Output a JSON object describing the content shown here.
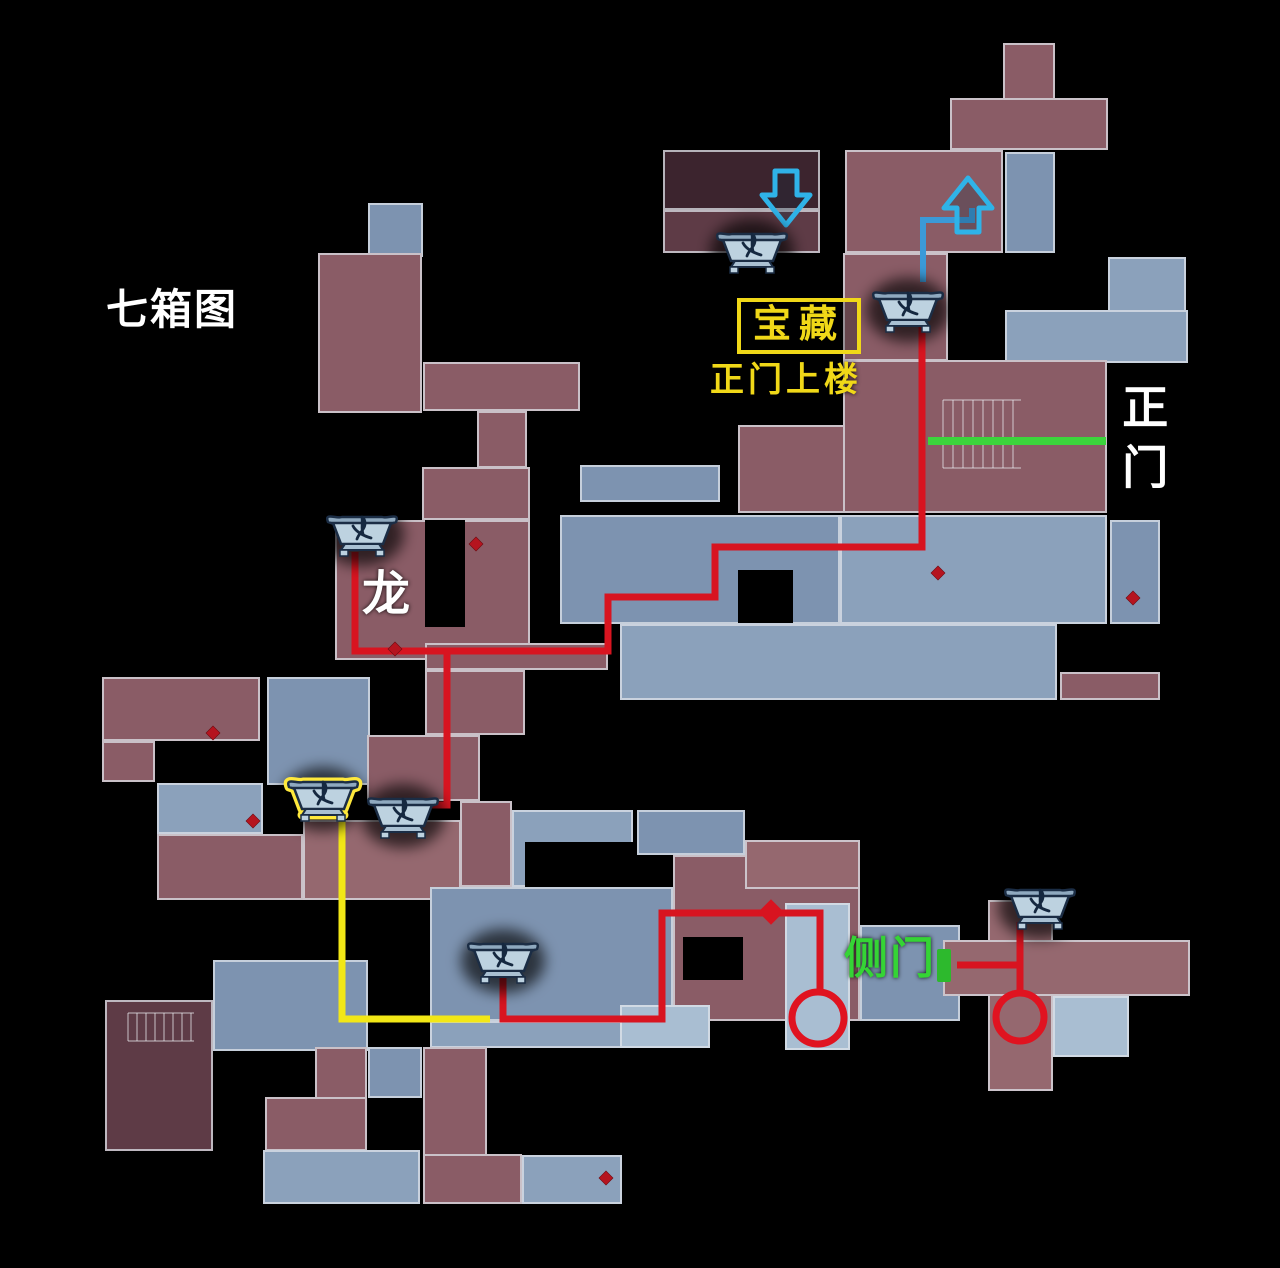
{
  "labels": {
    "title": {
      "text": "七箱图",
      "x": 106,
      "y": 288
    },
    "treasure": {
      "text": "宝藏",
      "x": 737,
      "y": 298
    },
    "treasure_sub": {
      "text": "正门上楼",
      "x": 710,
      "y": 363
    },
    "main_gate": {
      "text": "正门",
      "x": 1118,
      "y": 383
    },
    "dragon": {
      "text": "龙",
      "x": 362,
      "y": 570
    },
    "side_gate": {
      "text": "侧门",
      "x": 844,
      "y": 936
    }
  },
  "colors": {
    "route_red": "#d81420",
    "route_yellow": "#f2e716",
    "route_blue": "#3b9ad8",
    "gate_green": "#3cd43c",
    "label_yellow": "#f0d818",
    "label_green": "#35d435",
    "label_white": "#ffffff",
    "arrow_cyan": "#2fb3e8",
    "diamond_red": "#b5141f",
    "chest_highlight": "#ffe93c",
    "wall": "rgba(223,227,234,0.75)"
  },
  "map": {
    "palette": {
      "red": "#8a5c66",
      "red2": "#95686f",
      "darkred": "#5e3b46",
      "deepred": "#3c242e",
      "blue": "#7d93b0",
      "blue2": "#8ba1bb",
      "pale": "#a9bed2"
    },
    "rooms": [
      [
        1003,
        43,
        52,
        107,
        "red"
      ],
      [
        950,
        98,
        158,
        52,
        "red"
      ],
      [
        845,
        150,
        158,
        103,
        "red"
      ],
      [
        1005,
        152,
        50,
        101,
        "blue"
      ],
      [
        843,
        253,
        105,
        108,
        "red"
      ],
      [
        1108,
        257,
        78,
        84,
        "blue2"
      ],
      [
        1005,
        310,
        183,
        53,
        "blue2"
      ],
      [
        663,
        150,
        157,
        60,
        "deepred"
      ],
      [
        663,
        210,
        157,
        43,
        "darkred"
      ],
      [
        368,
        203,
        55,
        54,
        "blue"
      ],
      [
        318,
        253,
        104,
        160,
        "red"
      ],
      [
        423,
        362,
        157,
        49,
        "red"
      ],
      [
        477,
        411,
        50,
        57,
        "red"
      ],
      [
        422,
        467,
        108,
        53,
        "red"
      ],
      [
        335,
        520,
        195,
        140,
        "red"
      ],
      [
        425,
        643,
        183,
        27,
        "red"
      ],
      [
        425,
        670,
        100,
        65,
        "red"
      ],
      [
        580,
        465,
        140,
        37,
        "blue"
      ],
      [
        738,
        425,
        107,
        88,
        "red"
      ],
      [
        843,
        360,
        264,
        153,
        "red"
      ],
      [
        560,
        515,
        280,
        109,
        "blue"
      ],
      [
        840,
        515,
        267,
        109,
        "blue2"
      ],
      [
        1110,
        520,
        50,
        104,
        "blue"
      ],
      [
        620,
        624,
        437,
        76,
        "blue2"
      ],
      [
        1060,
        672,
        100,
        28,
        "red"
      ],
      [
        102,
        677,
        158,
        64,
        "red"
      ],
      [
        102,
        741,
        53,
        41,
        "red"
      ],
      [
        267,
        677,
        103,
        108,
        "blue"
      ],
      [
        367,
        735,
        113,
        66,
        "red"
      ],
      [
        157,
        783,
        106,
        51,
        "blue2"
      ],
      [
        157,
        834,
        146,
        66,
        "red"
      ],
      [
        303,
        820,
        158,
        80,
        "red2"
      ],
      [
        460,
        801,
        52,
        86,
        "red"
      ],
      [
        512,
        810,
        121,
        77,
        "blue2"
      ],
      [
        637,
        810,
        108,
        45,
        "blue"
      ],
      [
        430,
        887,
        243,
        134,
        "blue"
      ],
      [
        673,
        855,
        187,
        166,
        "red"
      ],
      [
        860,
        925,
        100,
        96,
        "blue"
      ],
      [
        745,
        840,
        115,
        49,
        "red2"
      ],
      [
        430,
        1021,
        280,
        27,
        "blue2"
      ],
      [
        213,
        960,
        155,
        91,
        "blue"
      ],
      [
        105,
        1000,
        108,
        151,
        "darkred"
      ],
      [
        785,
        903,
        65,
        147,
        "pale"
      ],
      [
        988,
        900,
        65,
        191,
        "red2"
      ],
      [
        943,
        940,
        247,
        56,
        "red2"
      ],
      [
        1053,
        996,
        76,
        61,
        "pale"
      ],
      [
        315,
        1047,
        52,
        104,
        "red"
      ],
      [
        265,
        1097,
        102,
        54,
        "red"
      ],
      [
        368,
        1047,
        54,
        51,
        "blue"
      ],
      [
        423,
        1047,
        64,
        157,
        "red"
      ],
      [
        423,
        1154,
        99,
        50,
        "red"
      ],
      [
        263,
        1150,
        157,
        54,
        "blue2"
      ],
      [
        522,
        1155,
        100,
        49,
        "blue2"
      ],
      [
        620,
        1005,
        90,
        43,
        "pale"
      ]
    ],
    "holes": [
      [
        425,
        520,
        40,
        107
      ],
      [
        738,
        570,
        55,
        53
      ],
      [
        525,
        842,
        108,
        45
      ],
      [
        683,
        937,
        60,
        43
      ]
    ],
    "stairs": [
      {
        "x": 943,
        "y": 400,
        "w": 78,
        "h": 68,
        "step": 10
      },
      {
        "x": 128,
        "y": 1013,
        "w": 66,
        "h": 28,
        "step": 9
      }
    ],
    "diamonds": [
      [
        395,
        649
      ],
      [
        476,
        544
      ],
      [
        1133,
        598
      ],
      [
        606,
        1178
      ],
      [
        213,
        733
      ],
      [
        253,
        821
      ],
      [
        938,
        573
      ]
    ]
  },
  "routes": {
    "red": [
      [
        [
          922,
          318
        ],
        [
          922,
          547
        ],
        [
          715,
          547
        ],
        [
          715,
          597
        ],
        [
          608,
          597
        ],
        [
          608,
          651
        ],
        [
          355,
          651
        ],
        [
          355,
          552
        ]
      ],
      [
        [
          447,
          651
        ],
        [
          447,
          805
        ],
        [
          388,
          805
        ]
      ],
      [
        [
          503,
          975
        ],
        [
          503,
          1019
        ],
        [
          662,
          1019
        ],
        [
          662,
          913
        ],
        [
          820,
          913
        ],
        [
          820,
          994
        ]
      ],
      [
        [
          1020,
          922
        ],
        [
          1020,
          996
        ]
      ],
      [
        [
          957,
          965
        ],
        [
          1022,
          965
        ]
      ]
    ],
    "yellow": [
      [
        [
          342,
          812
        ],
        [
          342,
          1019
        ],
        [
          490,
          1019
        ]
      ]
    ],
    "blue": [
      [
        [
          972,
          208
        ],
        [
          972,
          220
        ],
        [
          923,
          220
        ],
        [
          923,
          282
        ]
      ]
    ]
  },
  "route_arrow": {
    "x": 771,
    "y": 912
  },
  "circles": [
    [
      818,
      1018,
      26
    ],
    [
      1020,
      1017,
      24
    ]
  ],
  "arrows": [
    {
      "dir": "down",
      "x": 786,
      "y": 201
    },
    {
      "dir": "up",
      "x": 968,
      "y": 202
    }
  ],
  "gate_line": [
    928,
    441,
    1106,
    441
  ],
  "door_marker": [
    937,
    949,
    14,
    33
  ],
  "chests": [
    {
      "x": 752,
      "y": 247,
      "highlight": false
    },
    {
      "x": 908,
      "y": 306,
      "highlight": false
    },
    {
      "x": 362,
      "y": 530,
      "highlight": false
    },
    {
      "x": 323,
      "y": 795,
      "highlight": true
    },
    {
      "x": 403,
      "y": 812,
      "highlight": false
    },
    {
      "x": 503,
      "y": 957,
      "highlight": false
    },
    {
      "x": 1040,
      "y": 903,
      "highlight": false
    }
  ]
}
